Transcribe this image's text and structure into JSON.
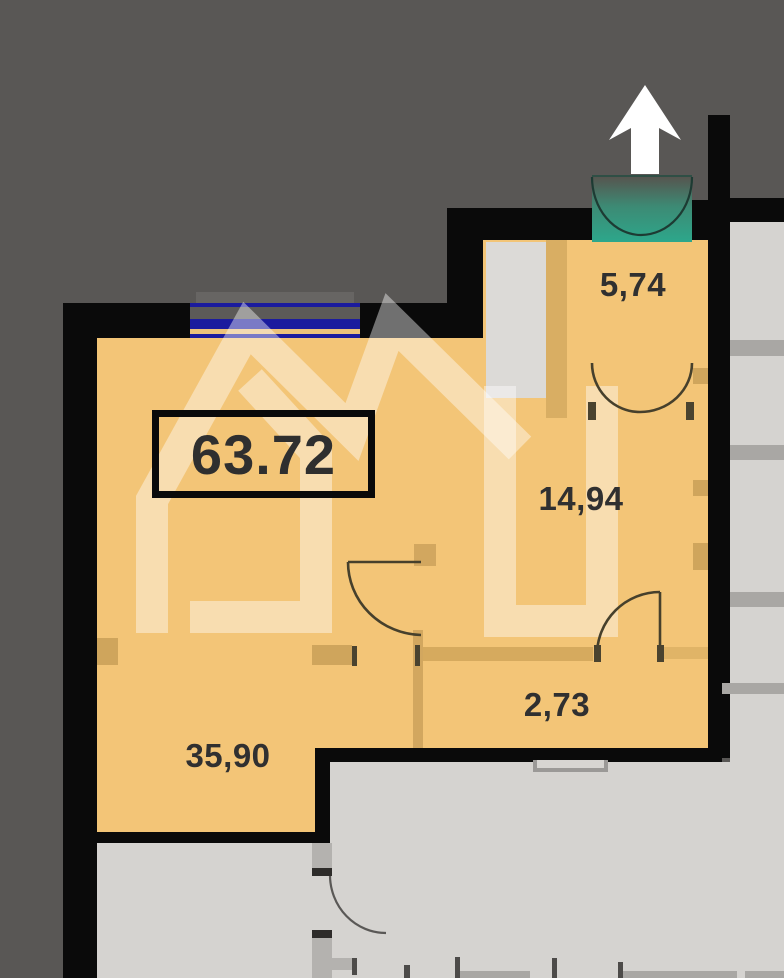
{
  "plan": {
    "title": "apartment-floor-plan",
    "total_area_label": "63.72",
    "rooms": [
      {
        "name": "entrance-hall",
        "area": "5,74"
      },
      {
        "name": "bedroom",
        "area": "14,94"
      },
      {
        "name": "corridor",
        "area": "2,73"
      },
      {
        "name": "living-room",
        "area": "35,90"
      }
    ],
    "north_arrow": "up-arrow-icon",
    "entrance": "double-door-balcony-entrance"
  },
  "colors": {
    "background_dark": "#595755",
    "wall_black": "#0a0a0a",
    "floor_orange": "#f3c577",
    "partition_tan": "#d2a75f",
    "neighbor_gray": "#d5d3d0",
    "niche_gray": "#dcdad7",
    "band_gray": "#a9a7a4",
    "window_blue": "#1b1b9e",
    "entrance_teal": "#2da78b",
    "watermark_white": "rgba(255,255,255,0.42)",
    "text": "#303030"
  }
}
